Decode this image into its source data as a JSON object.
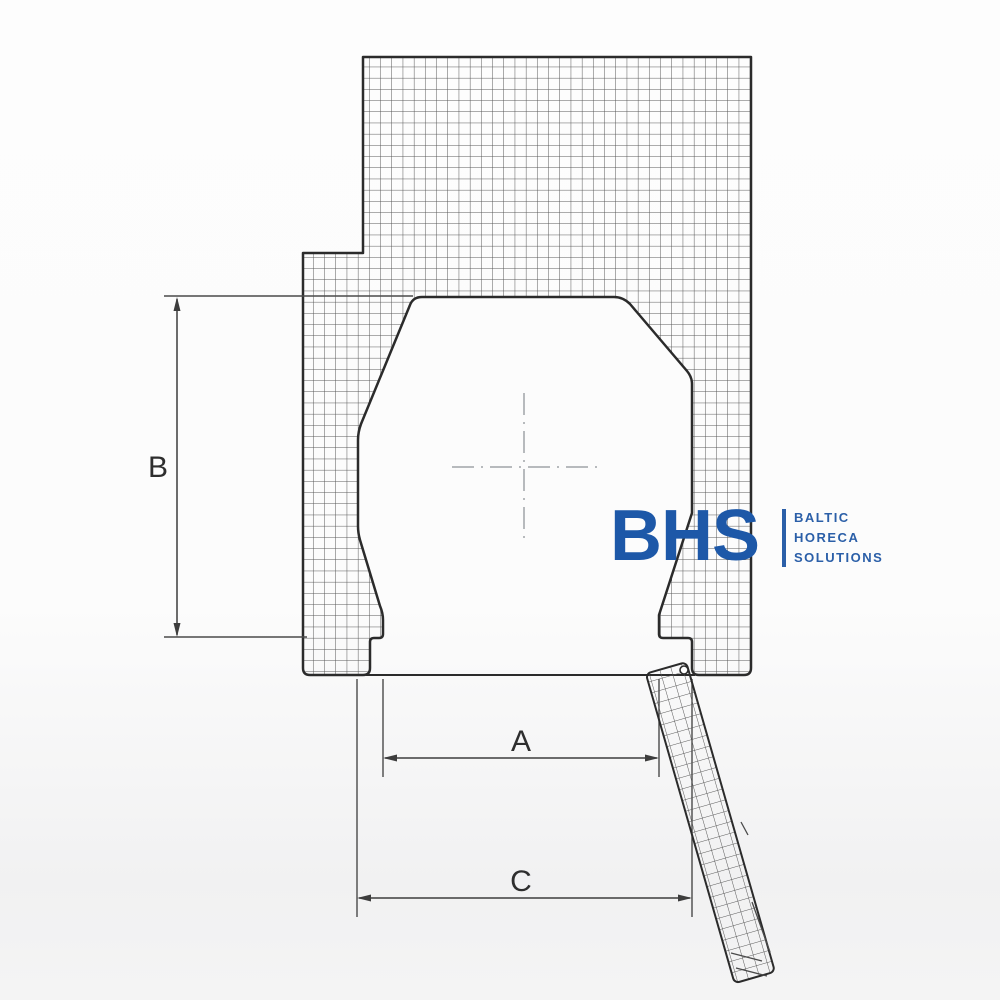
{
  "drawing": {
    "title": "kettle-cross-section",
    "dimensions": {
      "a_label": "A",
      "b_label": "B",
      "c_label": "C"
    },
    "colors": {
      "outline": "#2b2b2b",
      "hatch": "#575757",
      "dimension_line": "#3d3d3d",
      "centerline": "#b7babd",
      "background": "#fcfcfc"
    }
  },
  "logo": {
    "acronym": "BHS",
    "lines": [
      "BALTIC",
      "HORECA",
      "SOLUTIONS"
    ],
    "color_primary": "#1d58a8",
    "color_secondary": "#2b5fa8"
  }
}
